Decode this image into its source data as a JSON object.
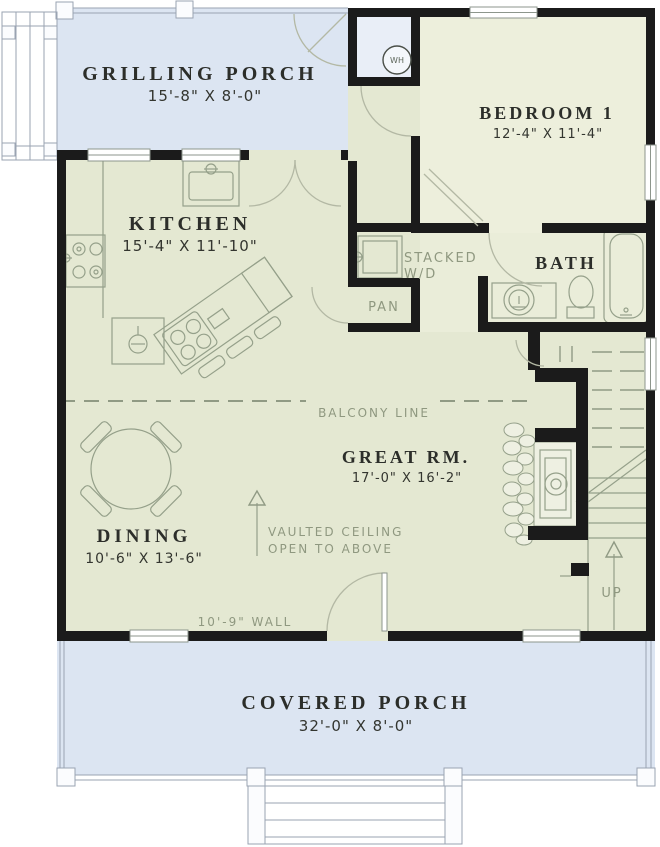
{
  "plan": {
    "rooms": {
      "grilling_porch": {
        "name": "GRILLING PORCH",
        "dims": "15'-8\" X 8'-0\""
      },
      "bedroom1": {
        "name": "BEDROOM 1",
        "dims": "12'-4\" X 11'-4\""
      },
      "kitchen": {
        "name": "KITCHEN",
        "dims": "15'-4\" X 11'-10\""
      },
      "bath": {
        "name": "BATH"
      },
      "great_room": {
        "name": "GREAT RM.",
        "dims": "17'-0\" X 16'-2\""
      },
      "dining": {
        "name": "DINING",
        "dims": "10'-6\" X 13'-6\""
      },
      "covered_porch": {
        "name": "COVERED PORCH",
        "dims": "32'-0\" X 8'-0\""
      }
    },
    "annotations": {
      "stacked_wd_line1": "STACKED",
      "stacked_wd_line2": "W/D",
      "pantry": "PAN",
      "balcony": "BALCONY LINE",
      "vaulted_line1": "VAULTED CEILING",
      "vaulted_line2": "OPEN TO ABOVE",
      "wall_note": "10'-9\" WALL",
      "up": "UP",
      "water_heater": "WH"
    },
    "colors": {
      "porch_fill": "#dce5f2",
      "interior_fill": "#e4e8d2",
      "bedroom_fill": "#edefdc",
      "closet_fill": "#e9eef7",
      "wall": "#1b1b1b",
      "linework": "#99a28e",
      "annotation_text": "#8f9880",
      "room_text": "#2c2e2a"
    }
  }
}
